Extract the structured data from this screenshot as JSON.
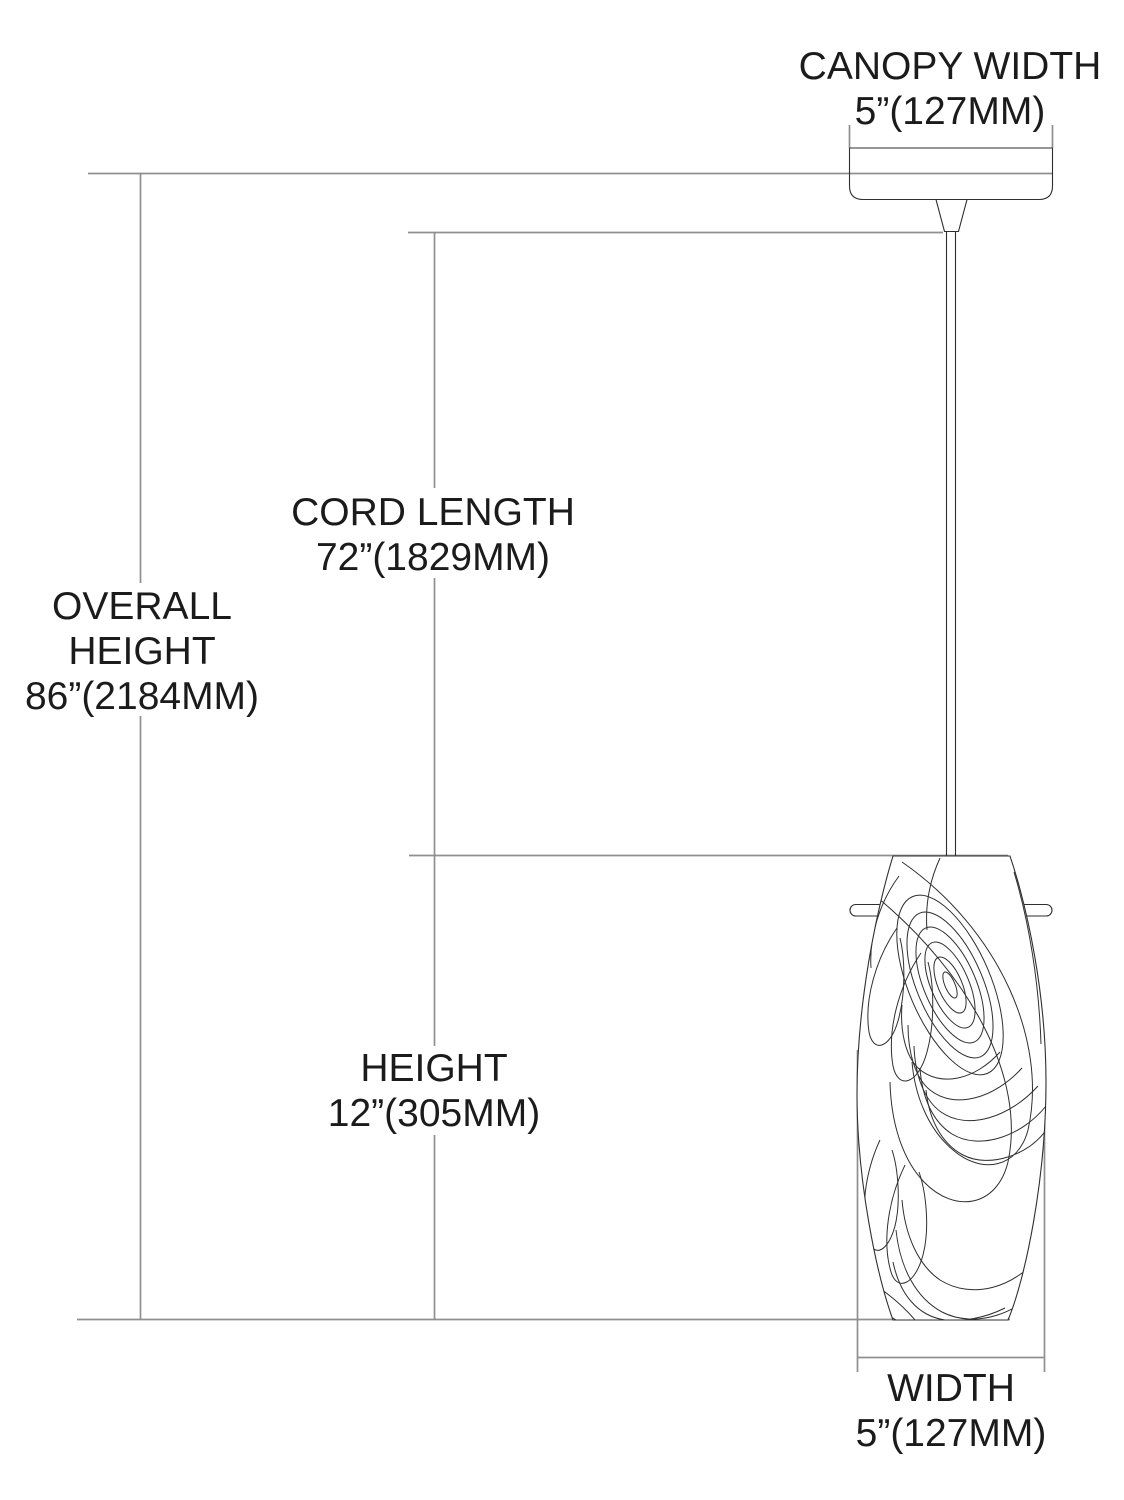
{
  "diagram": {
    "title": "pendant-light-dimension-diagram",
    "dimensions": {
      "canopy_width": {
        "label": "CANOPY WIDTH",
        "value": "5”(127MM)"
      },
      "cord_length": {
        "label": "CORD LENGTH",
        "value": "72”(1829MM)"
      },
      "overall_height": {
        "label_line1": "OVERALL",
        "label_line2": "HEIGHT",
        "value": "86”(2184MM)"
      },
      "height": {
        "label": "HEIGHT",
        "value": "12”(305MM)"
      },
      "width": {
        "label": "WIDTH",
        "value": "5”(127MM)"
      }
    },
    "colors": {
      "dimension_line": "#8f8f8f",
      "drawing_line": "#2f2f2f",
      "text": "#1b1b1b",
      "background": "#ffffff"
    }
  }
}
